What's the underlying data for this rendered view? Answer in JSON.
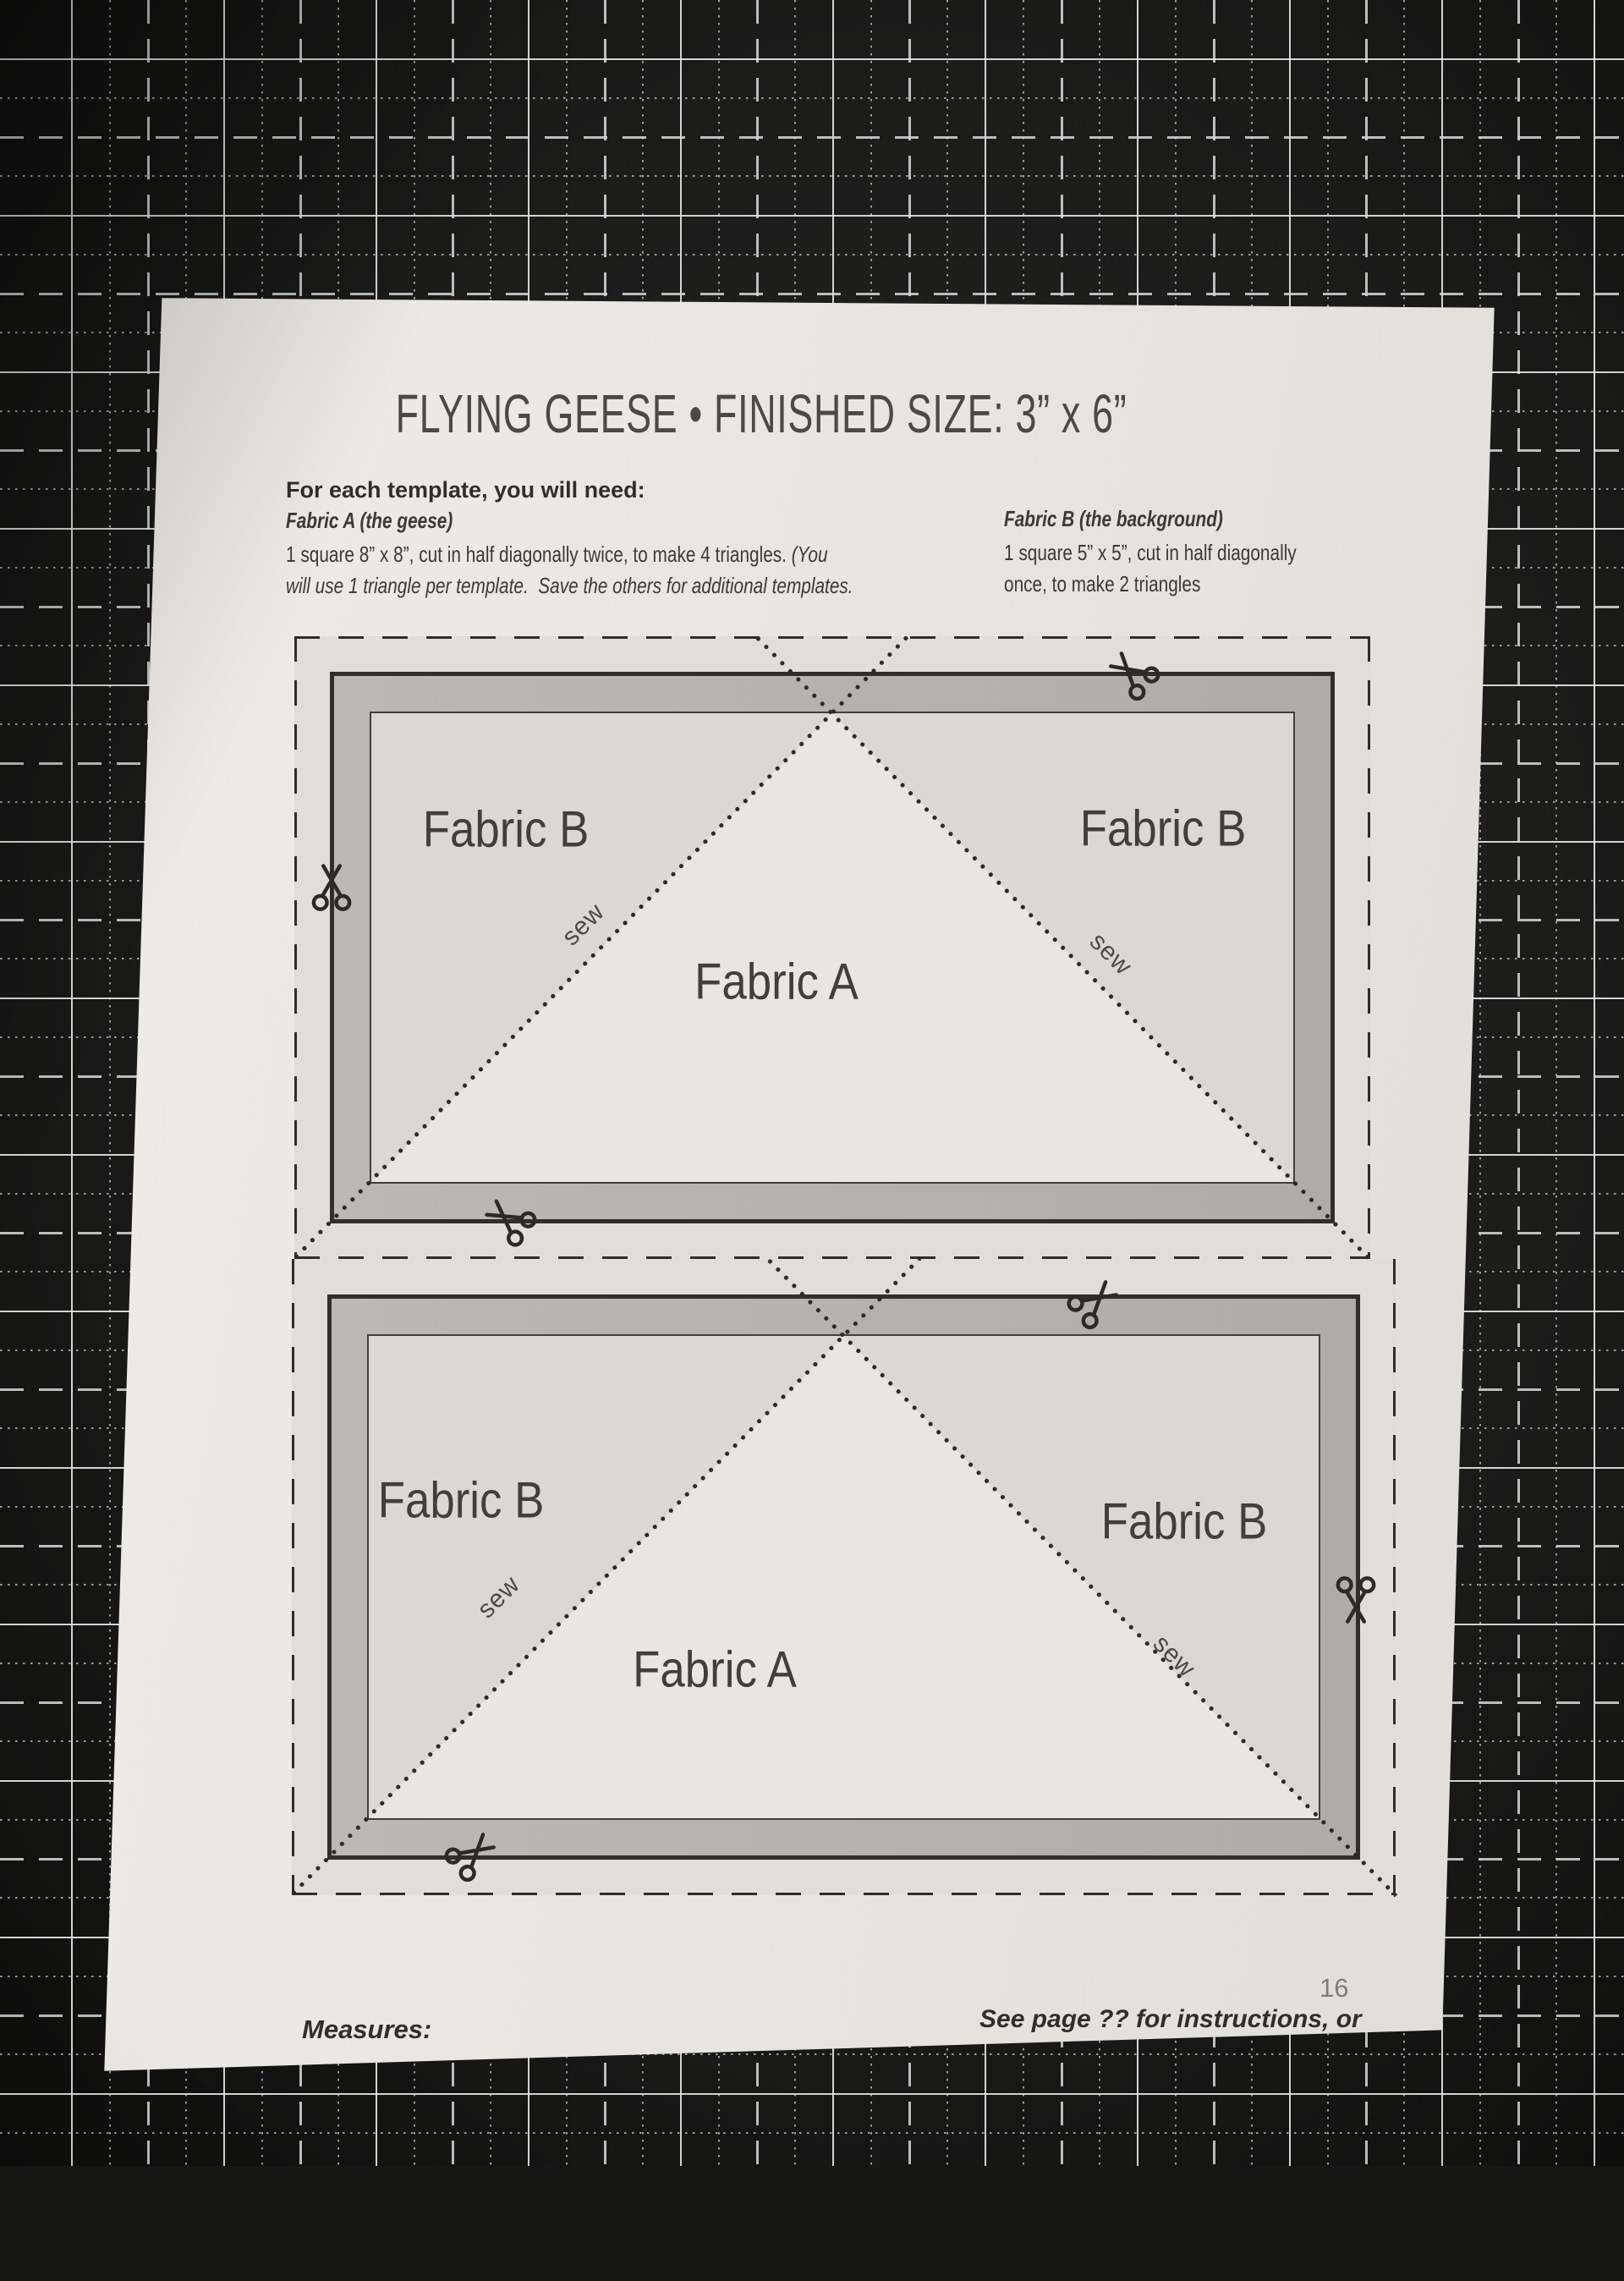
{
  "page": {
    "title": "FLYING GEESE • FINISHED SIZE: 3” x 6”",
    "page_number": "16"
  },
  "materials": {
    "heading": "For each template, you will need:",
    "fabric_a": {
      "title": "Fabric A (the geese)",
      "line1_regular": "1 square 8” x 8”, cut in half diagonally twice, to make 4 triangles. ",
      "line1_italic": "(You",
      "line2": "will use 1 triangle per template.  Save the others for additional templates."
    },
    "fabric_b": {
      "title": "Fabric B (the background)",
      "line1": "1 square 5” x 5”, cut in half diagonally",
      "line2": "once, to make 2 triangles"
    }
  },
  "templates": [
    {
      "fabric_b_left": "Fabric B",
      "fabric_b_right": "Fabric B",
      "fabric_a": "Fabric A",
      "sew_left": "sew",
      "sew_right": "sew"
    },
    {
      "fabric_b_left": "Fabric B",
      "fabric_b_right": "Fabric B",
      "fabric_a": "Fabric A",
      "sew_left": "sew",
      "sew_right": "sew"
    }
  ],
  "footer": {
    "measures_heading": "Measures:",
    "measures_line": "3” x 6” finished   •   3-1/2” x 6-1/2” unfinished",
    "see_line1": "See page ?? for instructions, or",
    "see_line2": "visit ?? for a how-to video."
  },
  "icons": {
    "scissors": "scissors-icon (cut here)"
  },
  "colors": {
    "mat_black": "#1b1b1a",
    "mat_grid_line": "#dfe4e2",
    "paper": "#e9e5e0",
    "template_margin": "#e1ddd8",
    "seam_band_gray": "#b5b1ac",
    "fabric_b_fill": "#dbd7d3",
    "fabric_a_fill": "#e9e6e1",
    "ink": "#2f2e2c"
  }
}
